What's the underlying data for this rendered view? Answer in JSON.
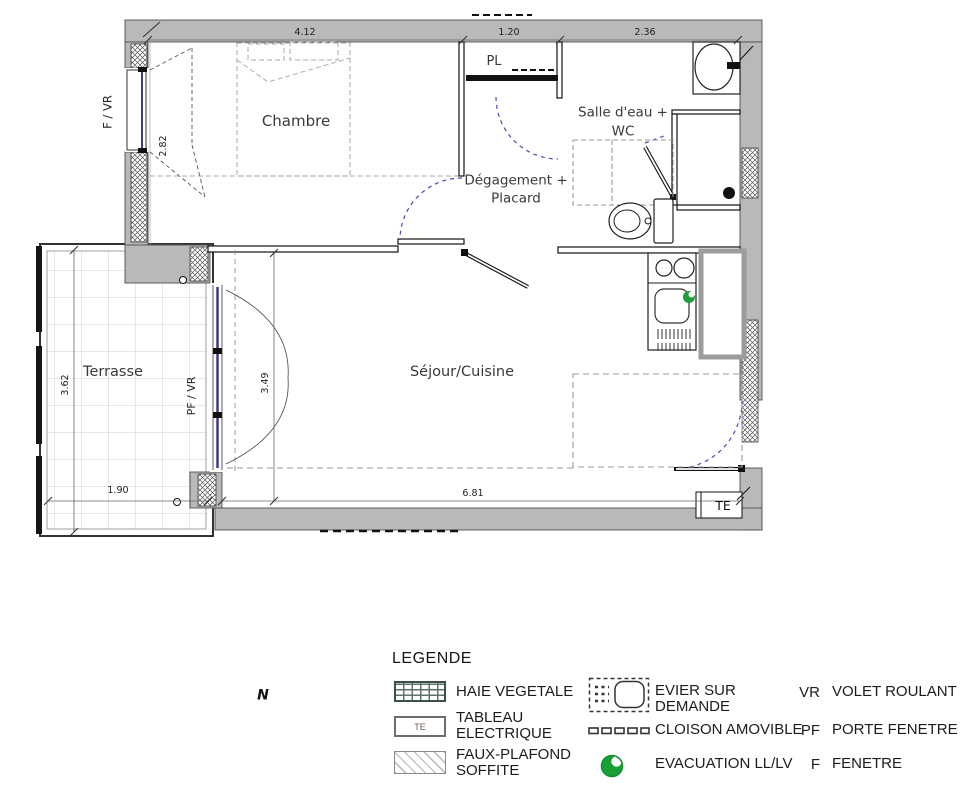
{
  "plan": {
    "rooms": {
      "chambre": "Chambre",
      "terrasse": "Terrasse",
      "sejour_cuisine": "Séjour/Cuisine",
      "degagement_line1": "Dégagement +",
      "degagement_line2": "Placard",
      "salle_eau_line1": "Salle d'eau +",
      "salle_eau_line2": "WC",
      "placard": "PL"
    },
    "annotations": {
      "window_left": "F / VR",
      "terrace_door": "PF / VR",
      "electrical_panel": "TE"
    },
    "dimensions": {
      "chambre_width": "4.12",
      "placard_width": "1.20",
      "salle_eau_width": "2.36",
      "chambre_depth": "2.82",
      "sejour_depth": "3.49",
      "terrasse_depth": "3.62",
      "terrasse_width": "1.90",
      "sejour_width": "6.81"
    }
  },
  "compass": {
    "north": "N"
  },
  "legend": {
    "title": "LEGENDE",
    "items": [
      {
        "id": "haie-vegetale",
        "lines": [
          "HAIE VEGETALE"
        ]
      },
      {
        "id": "tableau-electrique",
        "symbol_text": "TE",
        "lines": [
          "TABLEAU",
          "ELECTRIQUE"
        ]
      },
      {
        "id": "faux-plafond",
        "lines": [
          "FAUX-PLAFOND",
          "SOFFITE"
        ]
      },
      {
        "id": "evier-sur-demande",
        "lines": [
          "EVIER SUR",
          "DEMANDE"
        ]
      },
      {
        "id": "cloison-amovible",
        "lines": [
          "CLOISON AMOVIBLE"
        ]
      },
      {
        "id": "evacuation",
        "lines": [
          "EVACUATION LL/LV"
        ]
      }
    ],
    "abbreviations": [
      {
        "abbr": "VR",
        "label": "VOLET ROULANT"
      },
      {
        "abbr": "PF",
        "label": "PORTE FENETRE"
      },
      {
        "abbr": "F",
        "label": "FENETRE"
      }
    ]
  },
  "colors": {
    "wall_gray": "#b9b9b9",
    "door_arc_blue": "#4a4ab8",
    "window_blue": "#3c3c8e",
    "evacuation_green": "#1f9e3c"
  }
}
